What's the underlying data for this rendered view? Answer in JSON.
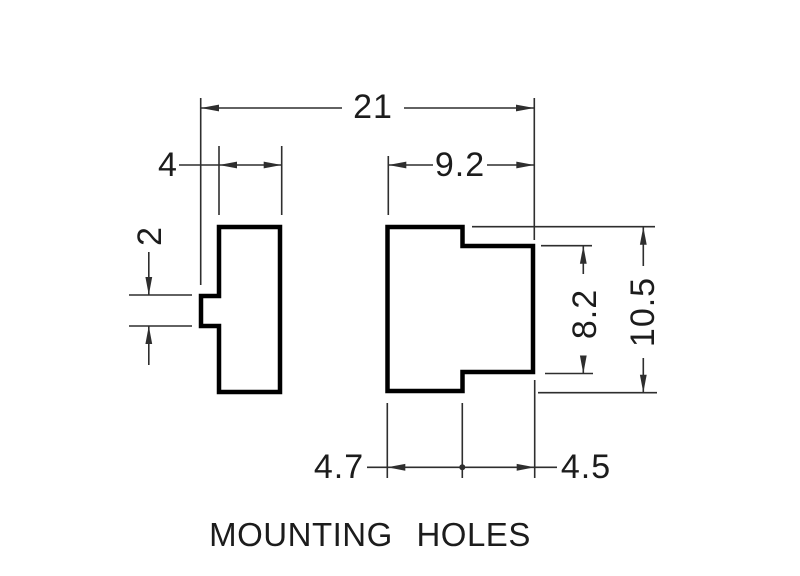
{
  "title": "MOUNTING HOLES",
  "dimensions": {
    "overall_width": "21",
    "left_part_width": "4",
    "right_part_width": "9.2",
    "notch_height": "2",
    "inner_step_height": "8.2",
    "overall_height": "10.5",
    "offset_left": "4.7",
    "offset_right": "4.5"
  },
  "colors": {
    "outline": "#000000",
    "dimension_line": "#2e2e2e",
    "text": "#1c1c1c",
    "background": "#ffffff"
  }
}
